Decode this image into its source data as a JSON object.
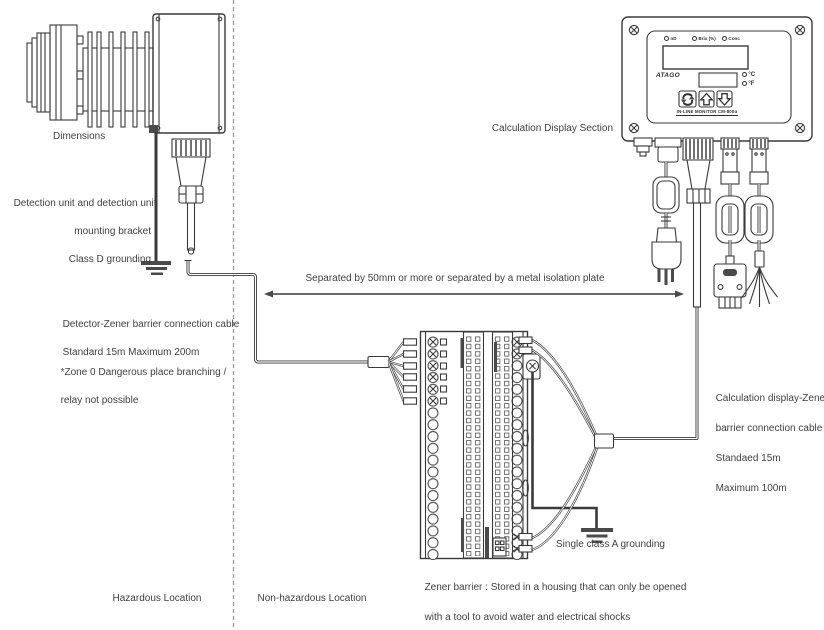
{
  "diagram": {
    "dimensions_label": "Dimensions",
    "calc_display_label": "Calculation Display Section",
    "detection_ground_lines": [
      "Detection unit and detection unit",
      "mounting bracket",
      "Class D grounding"
    ],
    "detector_cable_lines": [
      "Detector-Zener barrier connection cable",
      "Standard 15m Maximum 200m"
    ],
    "zone_note_lines": [
      "*Zone 0 Dangerous place branching /",
      "relay not possible"
    ],
    "separation_label": "Separated by 50mm or more or separated by a metal isolation plate",
    "calc_cable_lines": [
      "Calculation display-Zener",
      "barrier connection cable",
      "Standaed 15m",
      "Maximum 100m"
    ],
    "single_ground_label": "Single class A grounding",
    "zener_caption_lines": [
      "Zener barrier : Stored in a housing that can only be opened",
      "with a tool to avoid water and electrical shocks"
    ],
    "hazardous_label": "Hazardous Location",
    "non_hazardous_label": "Non-hazardous Location"
  },
  "monitor": {
    "led_labels": [
      "nD",
      "Brix (%)",
      "Conc"
    ],
    "brand": "ATAGO",
    "temp_c": "°C",
    "temp_f": "°F",
    "model_label": "IN-LINE MONITOR CM-800α"
  },
  "colors": {
    "line": "#3a3a3a",
    "text": "#3f3f3f",
    "dashed": "#9a9a9a"
  }
}
